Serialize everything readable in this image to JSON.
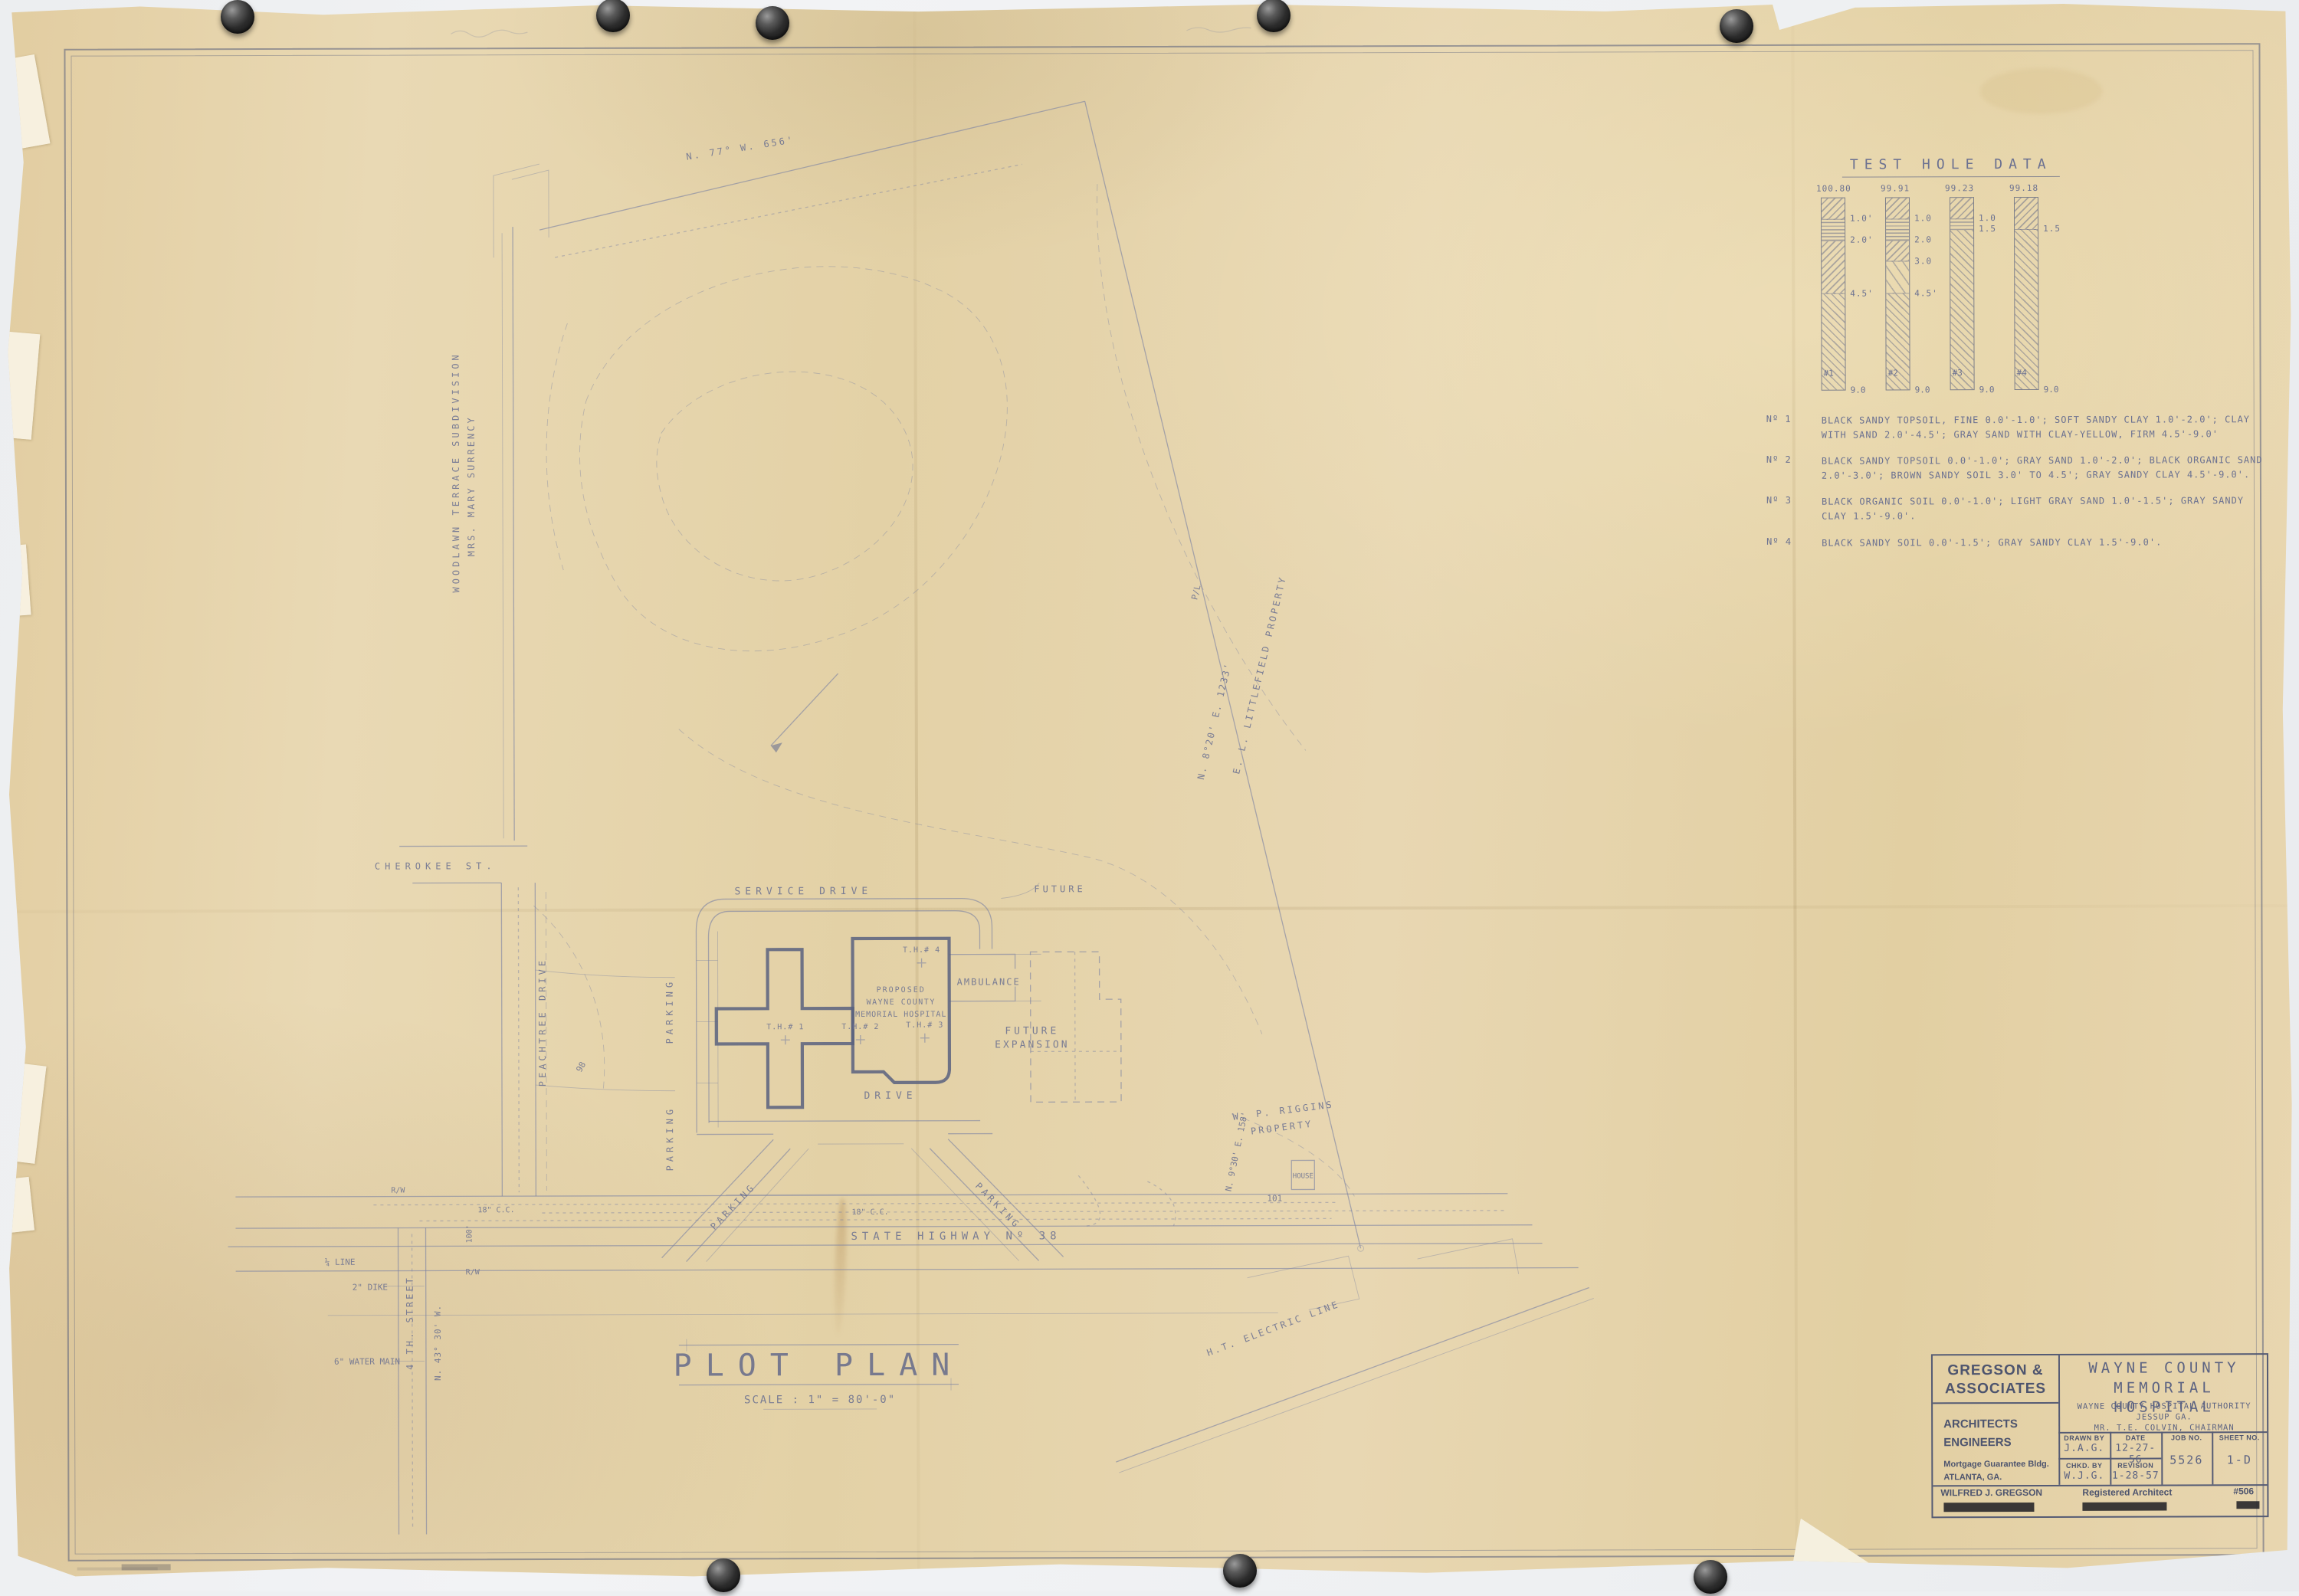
{
  "colors": {
    "background": "#eef0f2",
    "paper": "#e7d5ae",
    "ink": "#6b7191",
    "title_block_ink": "#4d546e",
    "pin": "#2b2b2b"
  },
  "plan": {
    "title": "PLOT PLAN",
    "scale_label": "SCALE : 1\" = 80'-0\"",
    "building_line_1": "PROPOSED",
    "building_line_2": "WAYNE COUNTY",
    "building_line_3": "MEMORIAL HOSPITAL",
    "service_drive": "SERVICE DRIVE",
    "drive": "DRIVE",
    "parking": "PARKING",
    "ambulance": "AMBULANCE",
    "future": "FUTURE",
    "future_expansion_1": "FUTURE",
    "future_expansion_2": "EXPANSION",
    "state_highway": "STATE HIGHWAY Nº 38",
    "peachtree_drive": "PEACHTREE DRIVE",
    "cherokee_st": "CHEROKEE ST.",
    "fourth_street": "4 TH. STREET",
    "woodlawn_1": "WOODLAWN TERRACE SUBDIVISION",
    "woodlawn_2": "MRS. MARY SURRENCY",
    "littlefield": "E. L. LITTLEFIELD PROPERTY",
    "riggins_1": "W. P. RIGGINS",
    "riggins_2": "PROPERTY",
    "house": "HOUSE",
    "ht_electric": "H.T. ELECTRIC LINE",
    "bearing_top": "N. 77° W.  656'",
    "bearing_right": "N. 8°20' E.  1233'",
    "bearing_riggins": "N. 9°30' E. 158'",
    "bearing_fourth": "N. 43° 30' W.",
    "property_line": "P/L",
    "right_of_way": "R/W",
    "cc18": "18\" C.C.",
    "dim_100": "100'",
    "quarter_line": "¼ LINE",
    "dike": "2\" DIKE",
    "water_main": "6\" WATER MAIN",
    "contour_98": "98",
    "contour_101": "101",
    "th1": "T.H.# 1",
    "th2": "T.H.# 2",
    "th3": "T.H.# 3",
    "th4": "T.H.# 4"
  },
  "test_hole_chart": {
    "type": "bore-log-columns",
    "title": "TEST HOLE DATA",
    "depth_total_ft": 9.0,
    "bottom_label": "9.0",
    "holes": [
      {
        "id": "#1",
        "surface_elevation": "100.80",
        "marks": [
          {
            "d": 1.0,
            "label": "1.0'"
          },
          {
            "d": 2.0,
            "label": "2.0'"
          },
          {
            "d": 4.5,
            "label": "4.5'"
          }
        ],
        "segments": [
          {
            "from": 0,
            "to": 1.0,
            "pattern": "diag-down"
          },
          {
            "from": 1.0,
            "to": 2.0,
            "pattern": "horizontal"
          },
          {
            "from": 2.0,
            "to": 4.5,
            "pattern": "diag-down"
          },
          {
            "from": 4.5,
            "to": 9.0,
            "pattern": "diag-up"
          }
        ]
      },
      {
        "id": "#2",
        "surface_elevation": "99.91",
        "marks": [
          {
            "d": 1.0,
            "label": "1.0"
          },
          {
            "d": 2.0,
            "label": "2.0"
          },
          {
            "d": 3.0,
            "label": "3.0"
          },
          {
            "d": 4.5,
            "label": "4.5'"
          }
        ],
        "segments": [
          {
            "from": 0,
            "to": 1.0,
            "pattern": "diag-down"
          },
          {
            "from": 1.0,
            "to": 2.0,
            "pattern": "horizontal"
          },
          {
            "from": 2.0,
            "to": 3.0,
            "pattern": "diag-down"
          },
          {
            "from": 3.0,
            "to": 4.5,
            "pattern": "diag-sparse"
          },
          {
            "from": 4.5,
            "to": 9.0,
            "pattern": "diag-up"
          }
        ]
      },
      {
        "id": "#3",
        "surface_elevation": "99.23",
        "marks": [
          {
            "d": 1.0,
            "label": "1.0"
          },
          {
            "d": 1.5,
            "label": "1.5"
          }
        ],
        "segments": [
          {
            "from": 0,
            "to": 1.0,
            "pattern": "diag-down"
          },
          {
            "from": 1.0,
            "to": 1.5,
            "pattern": "horizontal"
          },
          {
            "from": 1.5,
            "to": 9.0,
            "pattern": "diag-up"
          }
        ]
      },
      {
        "id": "#4",
        "surface_elevation": "99.18",
        "marks": [
          {
            "d": 1.5,
            "label": "1.5"
          }
        ],
        "segments": [
          {
            "from": 0,
            "to": 1.5,
            "pattern": "diag-down"
          },
          {
            "from": 1.5,
            "to": 9.0,
            "pattern": "diag-up"
          }
        ]
      }
    ],
    "notes": [
      {
        "label": "Nº 1",
        "text": "BLACK SANDY TOPSOIL, FINE 0.0'-1.0'; SOFT SANDY CLAY 1.0'-2.0'; CLAY WITH SAND 2.0'-4.5'; GRAY SAND WITH CLAY-YELLOW, FIRM 4.5'-9.0'"
      },
      {
        "label": "Nº 2",
        "text": "BLACK SANDY TOPSOIL 0.0'-1.0'; GRAY SAND 1.0'-2.0'; BLACK ORGANIC SAND 2.0'-3.0'; BROWN SANDY SOIL 3.0' TO 4.5'; GRAY SANDY CLAY 4.5'-9.0'."
      },
      {
        "label": "Nº 3",
        "text": "BLACK ORGANIC SOIL 0.0'-1.0'; LIGHT GRAY SAND 1.0'-1.5'; GRAY SANDY CLAY 1.5'-9.0'."
      },
      {
        "label": "Nº 4",
        "text": "BLACK SANDY SOIL 0.0'-1.5'; GRAY SANDY CLAY 1.5'-9.0'."
      }
    ]
  },
  "title_block": {
    "firm_line1": "GREGSON &",
    "firm_line2": "ASSOCIATES",
    "role_1": "ARCHITECTS",
    "role_2": "ENGINEERS",
    "address_1": "Mortgage Guarantee Bldg.",
    "address_2": "ATLANTA, GA.",
    "project_line1": "WAYNE COUNTY",
    "project_line2": "MEMORIAL HOSPITAL",
    "client_line1": "WAYNE COUNTY HOSPITAL AUTHORITY",
    "client_line2": "JESSUP GA.",
    "client_line3": "MR. T.E. COLVIN, CHAIRMAN",
    "drawn_by_label": "DRAWN BY",
    "drawn_by": "J.A.G.",
    "date_label": "DATE",
    "date": "12-27-56",
    "job_no_label": "JOB NO.",
    "job_no": "5526",
    "sheet_no_label": "SHEET NO.",
    "sheet_no": "1-D",
    "chkd_by_label": "CHKD. BY",
    "chkd_by": "W.J.G.",
    "revision_label": "REVISION",
    "revision": "1-28-57",
    "architect_name": "WILFRED J. GREGSON",
    "registered_title": "Registered Architect",
    "registration_no": "#506"
  }
}
